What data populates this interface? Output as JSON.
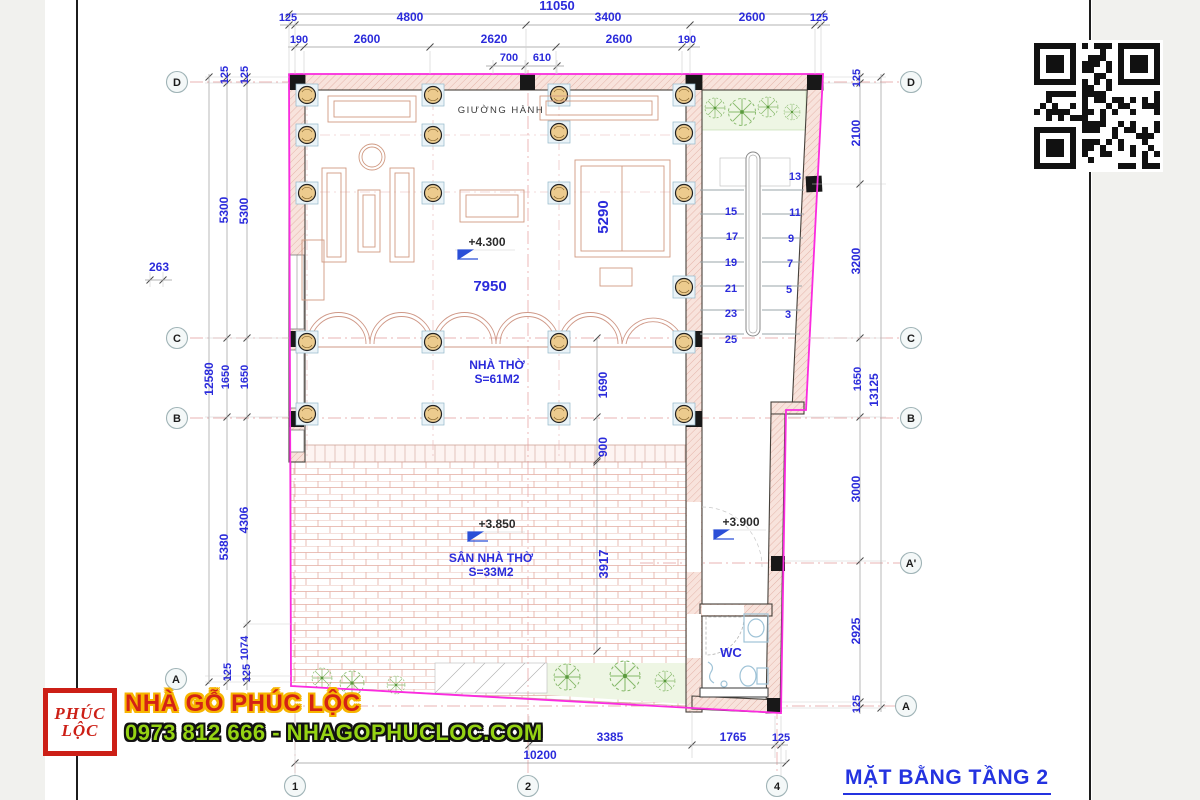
{
  "title": "MẶT BẰNG TẦNG 2",
  "branding": {
    "logo_top": "PHÚC",
    "logo_bottom": "LỘC",
    "name": "NHÀ GỖ PHÚC LỘC",
    "contact": "0973 812 666 - NHAGOPHUCLOC.COM"
  },
  "colors": {
    "dim_text_blue": "#2b2bdb",
    "boundary_magenta": "#fb2be0",
    "title_blue": "#2433e0",
    "brand_red": "#d42315",
    "brand_yellow": "#f7b500",
    "brand_green": "#95d313"
  },
  "grid": {
    "left": [
      "D",
      "C",
      "B",
      "A"
    ],
    "right": [
      "D",
      "C",
      "B",
      "A'",
      "A"
    ],
    "bottom": [
      "1",
      "2",
      "4"
    ]
  },
  "dims": {
    "top": {
      "overall": "11050",
      "chain1": [
        "125",
        "4800",
        "3400",
        "2600",
        "125"
      ],
      "chain2": [
        "190",
        "2600",
        "2620",
        "2600",
        "190"
      ],
      "door": [
        "700",
        "610"
      ]
    },
    "left": {
      "offset": "263",
      "overall": "12580",
      "chain1": [
        "125",
        "5300",
        "1650",
        "5380",
        "125"
      ],
      "chain2": [
        "125",
        "5300",
        "1650",
        "4306",
        "1074",
        "125"
      ]
    },
    "right": {
      "overall": "13125",
      "chain": [
        "125",
        "2100",
        "3200",
        "1650",
        "3000",
        "2925",
        "125"
      ]
    },
    "bottom": {
      "chain": [
        "3385",
        "1765",
        "125"
      ],
      "overall": "10200"
    }
  },
  "rooms": {
    "corridor": "GIƯỜNG HÀNH",
    "worship": {
      "name": "NHÀ THỜ",
      "area": "S=61M2"
    },
    "yard": {
      "name": "SÂN NHÀ THỜ",
      "area": "S=33M2"
    },
    "wc": "WC"
  },
  "levels": {
    "hall": "+4.300",
    "yard": "+3.850",
    "corridor": "+3.900"
  },
  "inner_dims": {
    "hall_width": "7950",
    "altar_depth": "5290",
    "porch_depth": "1690",
    "step_depth": "900",
    "yard_depth": "3917"
  },
  "stairs": {
    "left": [
      "15",
      "17",
      "19",
      "21",
      "23",
      "25"
    ],
    "right": [
      "13",
      "11",
      "9",
      "7",
      "5",
      "3"
    ]
  }
}
